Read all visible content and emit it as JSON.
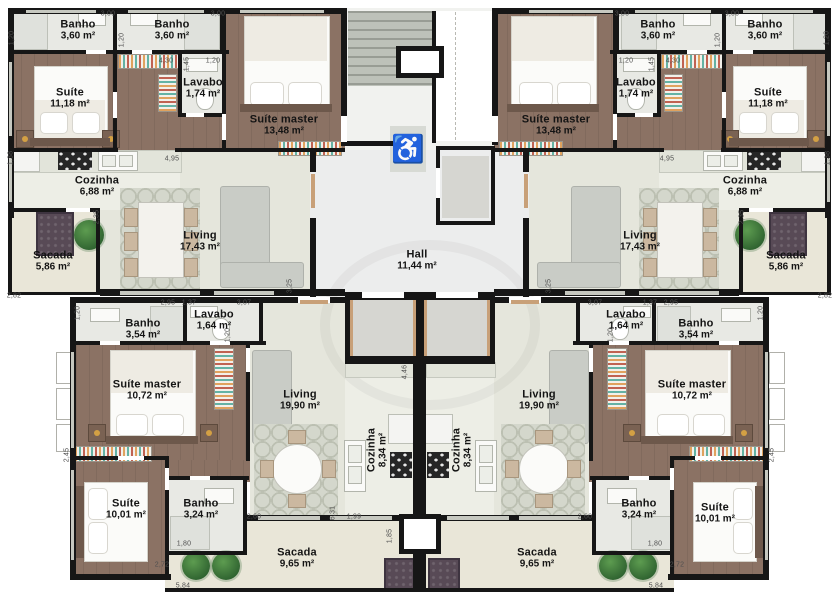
{
  "accessibility_icon": "♿",
  "rooms": [
    {
      "id": "tl-banho-1",
      "name": "Banho",
      "area": "3,60 m²",
      "x": 78,
      "y": 30
    },
    {
      "id": "tl-banho-2",
      "name": "Banho",
      "area": "3,60 m²",
      "x": 172,
      "y": 30
    },
    {
      "id": "tl-suite",
      "name": "Suíte",
      "area": "11,18 m²",
      "x": 70,
      "y": 98
    },
    {
      "id": "tl-lavabo",
      "name": "Lavabo",
      "area": "1,74 m²",
      "x": 203,
      "y": 88
    },
    {
      "id": "tl-suite-master",
      "name": "Suíte master",
      "area": "13,48 m²",
      "x": 284,
      "y": 125
    },
    {
      "id": "tl-cozinha",
      "name": "Cozinha",
      "area": "6,88 m²",
      "x": 97,
      "y": 186
    },
    {
      "id": "tl-living",
      "name": "Living",
      "area": "17,43 m²",
      "x": 200,
      "y": 241
    },
    {
      "id": "tl-sacada",
      "name": "Sacada",
      "area": "5,86 m²",
      "x": 53,
      "y": 261
    },
    {
      "id": "hall",
      "name": "Hall",
      "area": "11,44 m²",
      "x": 417,
      "y": 260
    },
    {
      "id": "tr-banho-1",
      "name": "Banho",
      "area": "3,60 m²",
      "x": 658,
      "y": 30
    },
    {
      "id": "tr-banho-2",
      "name": "Banho",
      "area": "3,60 m²",
      "x": 765,
      "y": 30
    },
    {
      "id": "tr-suite",
      "name": "Suíte",
      "area": "11,18 m²",
      "x": 768,
      "y": 98
    },
    {
      "id": "tr-lavabo",
      "name": "Lavabo",
      "area": "1,74 m²",
      "x": 636,
      "y": 88
    },
    {
      "id": "tr-suite-master",
      "name": "Suíte master",
      "area": "13,48 m²",
      "x": 556,
      "y": 125
    },
    {
      "id": "tr-cozinha",
      "name": "Cozinha",
      "area": "6,88 m²",
      "x": 745,
      "y": 186
    },
    {
      "id": "tr-living",
      "name": "Living",
      "area": "17,43 m²",
      "x": 640,
      "y": 241
    },
    {
      "id": "tr-sacada",
      "name": "Sacada",
      "area": "5,86 m²",
      "x": 786,
      "y": 261
    },
    {
      "id": "bl-banho-354",
      "name": "Banho",
      "area": "3,54 m²",
      "x": 143,
      "y": 329
    },
    {
      "id": "bl-lavabo",
      "name": "Lavabo",
      "area": "1,64 m²",
      "x": 214,
      "y": 320
    },
    {
      "id": "bl-suite-master",
      "name": "Suíte master",
      "area": "10,72 m²",
      "x": 147,
      "y": 390
    },
    {
      "id": "bl-living",
      "name": "Living",
      "area": "19,90 m²",
      "x": 300,
      "y": 400
    },
    {
      "id": "bl-cozinha",
      "name": "Cozinha",
      "area": "8,34 m²",
      "x": 377,
      "y": 450,
      "rot": 1
    },
    {
      "id": "bl-suite",
      "name": "Suíte",
      "area": "10,01 m²",
      "x": 126,
      "y": 509
    },
    {
      "id": "bl-banho-324",
      "name": "Banho",
      "area": "3,24 m²",
      "x": 201,
      "y": 509
    },
    {
      "id": "bl-sacada",
      "name": "Sacada",
      "area": "9,65 m²",
      "x": 297,
      "y": 558
    },
    {
      "id": "br-lavabo",
      "name": "Lavabo",
      "area": "1,64 m²",
      "x": 626,
      "y": 320
    },
    {
      "id": "br-banho-354",
      "name": "Banho",
      "area": "3,54 m²",
      "x": 696,
      "y": 329
    },
    {
      "id": "br-suite-master",
      "name": "Suíte master",
      "area": "10,72 m²",
      "x": 692,
      "y": 390
    },
    {
      "id": "br-living",
      "name": "Living",
      "area": "19,90 m²",
      "x": 539,
      "y": 400
    },
    {
      "id": "br-cozinha",
      "name": "Cozinha",
      "area": "8,34 m²",
      "x": 462,
      "y": 450,
      "rot": 1
    },
    {
      "id": "br-banho-324",
      "name": "Banho",
      "area": "3,24 m²",
      "x": 639,
      "y": 509
    },
    {
      "id": "br-suite",
      "name": "Suíte",
      "area": "10,01 m²",
      "x": 715,
      "y": 513
    },
    {
      "id": "br-sacada",
      "name": "Sacada",
      "area": "9,65 m²",
      "x": 537,
      "y": 558
    }
  ],
  "dimensions": [
    {
      "t": "3,00",
      "x": 108,
      "y": 14
    },
    {
      "t": "3,00",
      "x": 218,
      "y": 14
    },
    {
      "t": "3,00",
      "x": 622,
      "y": 14
    },
    {
      "t": "3,00",
      "x": 732,
      "y": 14
    },
    {
      "t": "1,20",
      "x": 12,
      "y": 38,
      "v": 1
    },
    {
      "t": "1,20",
      "x": 122,
      "y": 40,
      "v": 1
    },
    {
      "t": "1,20",
      "x": 718,
      "y": 40,
      "v": 1
    },
    {
      "t": "1,20",
      "x": 827,
      "y": 38,
      "v": 1
    },
    {
      "t": "4,30",
      "x": 166,
      "y": 61
    },
    {
      "t": "1,45",
      "x": 187,
      "y": 64,
      "v": 1
    },
    {
      "t": "1,20",
      "x": 213,
      "y": 61
    },
    {
      "t": "1,20",
      "x": 626,
      "y": 61
    },
    {
      "t": "1,45",
      "x": 652,
      "y": 64,
      "v": 1
    },
    {
      "t": "4,30",
      "x": 673,
      "y": 61
    },
    {
      "t": "1,38",
      "x": 11,
      "y": 158,
      "v": 1
    },
    {
      "t": "4,95",
      "x": 172,
      "y": 159
    },
    {
      "t": "4,95",
      "x": 667,
      "y": 159
    },
    {
      "t": "1,38",
      "x": 828,
      "y": 158,
      "v": 1
    },
    {
      "t": "2,35",
      "x": 97,
      "y": 217,
      "v": 1
    },
    {
      "t": "2,35",
      "x": 742,
      "y": 217,
      "v": 1
    },
    {
      "t": "2,82",
      "x": 14,
      "y": 296
    },
    {
      "t": "2,82",
      "x": 825,
      "y": 296
    },
    {
      "t": "3,25",
      "x": 290,
      "y": 286,
      "v": 1
    },
    {
      "t": "3,25",
      "x": 549,
      "y": 286,
      "v": 1
    },
    {
      "t": "2,95",
      "x": 168,
      "y": 303
    },
    {
      "t": "1,37",
      "x": 189,
      "y": 303
    },
    {
      "t": "3,07",
      "x": 244,
      "y": 303
    },
    {
      "t": "3,07",
      "x": 595,
      "y": 303
    },
    {
      "t": "1,37",
      "x": 650,
      "y": 303
    },
    {
      "t": "2,95",
      "x": 671,
      "y": 303
    },
    {
      "t": "1,20",
      "x": 78,
      "y": 313,
      "v": 1
    },
    {
      "t": "1,20",
      "x": 228,
      "y": 335,
      "v": 1
    },
    {
      "t": "1,20",
      "x": 611,
      "y": 335,
      "v": 1
    },
    {
      "t": "1,20",
      "x": 761,
      "y": 313,
      "v": 1
    },
    {
      "t": "4,46",
      "x": 405,
      "y": 372,
      "v": 1
    },
    {
      "t": "2,45",
      "x": 67,
      "y": 455,
      "v": 1
    },
    {
      "t": "2,45",
      "x": 772,
      "y": 455,
      "v": 1
    },
    {
      "t": "6,31",
      "x": 333,
      "y": 513,
      "v": 1
    },
    {
      "t": "1,99",
      "x": 354,
      "y": 517
    },
    {
      "t": "1,85",
      "x": 390,
      "y": 536,
      "v": 1
    },
    {
      "t": "2,60",
      "x": 254,
      "y": 517
    },
    {
      "t": "2,60",
      "x": 585,
      "y": 517
    },
    {
      "t": "1,80",
      "x": 184,
      "y": 544
    },
    {
      "t": "1,80",
      "x": 655,
      "y": 544
    },
    {
      "t": "2,72",
      "x": 162,
      "y": 565
    },
    {
      "t": "2,72",
      "x": 677,
      "y": 565
    },
    {
      "t": "5,84",
      "x": 183,
      "y": 586
    },
    {
      "t": "5,84",
      "x": 656,
      "y": 586
    }
  ],
  "colors": {
    "wall": "#161616",
    "wood": "#8b7264",
    "tile": "#e8e9e4",
    "living": "#e5e6dc",
    "kitchen": "#edeee6",
    "balcony": "#e9e6d8",
    "hall": "#eceded",
    "stairs": "#bdc1b9",
    "accent_blue": "#2456a0",
    "planter": "#584a56",
    "tree": "#3e7a3c",
    "door": "#c8a078"
  }
}
